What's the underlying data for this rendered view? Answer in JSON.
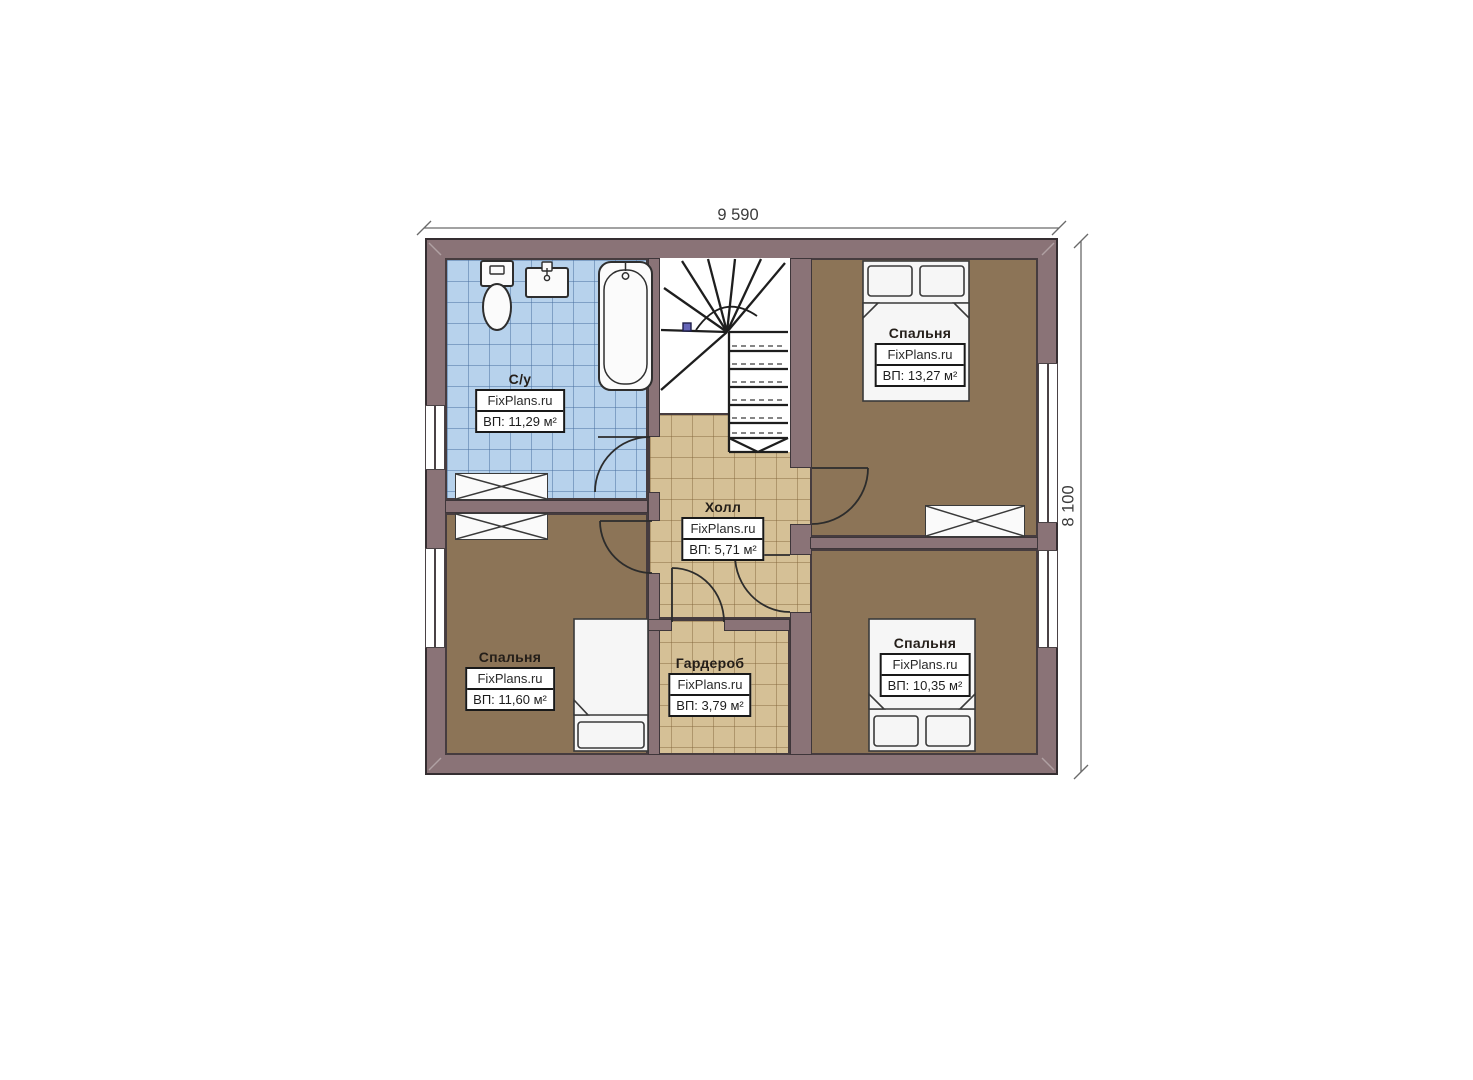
{
  "plan": {
    "dimension_width": "9 590",
    "dimension_height": "8 100",
    "watermark": "FixPlans.ru",
    "rooms": [
      {
        "key": "bathroom",
        "name": "С/у",
        "area": "ВП: 11,29 м²"
      },
      {
        "key": "bedroom-top-right",
        "name": "Спальня",
        "area": "ВП: 13,27 м²"
      },
      {
        "key": "hall",
        "name": "Холл",
        "area": "ВП: 5,71 м²"
      },
      {
        "key": "bedroom-bottom-left",
        "name": "Спальня",
        "area": "ВП: 11,60 м²"
      },
      {
        "key": "wardrobe",
        "name": "Гардероб",
        "area": "ВП: 3,79 м²"
      },
      {
        "key": "bedroom-bottom-right",
        "name": "Спальня",
        "area": "ВП: 10,35 м²"
      }
    ],
    "colors": {
      "wall": "#8a7377",
      "wall_outline": "#3e363a",
      "bedroom_floor": "#8c7457",
      "hall_floor": "#d5c096",
      "bathroom_floor": "#b7d2ec",
      "stair_area": "#ffffff",
      "fixture": "#fafafa",
      "stair_marker": "#6565b8"
    }
  }
}
